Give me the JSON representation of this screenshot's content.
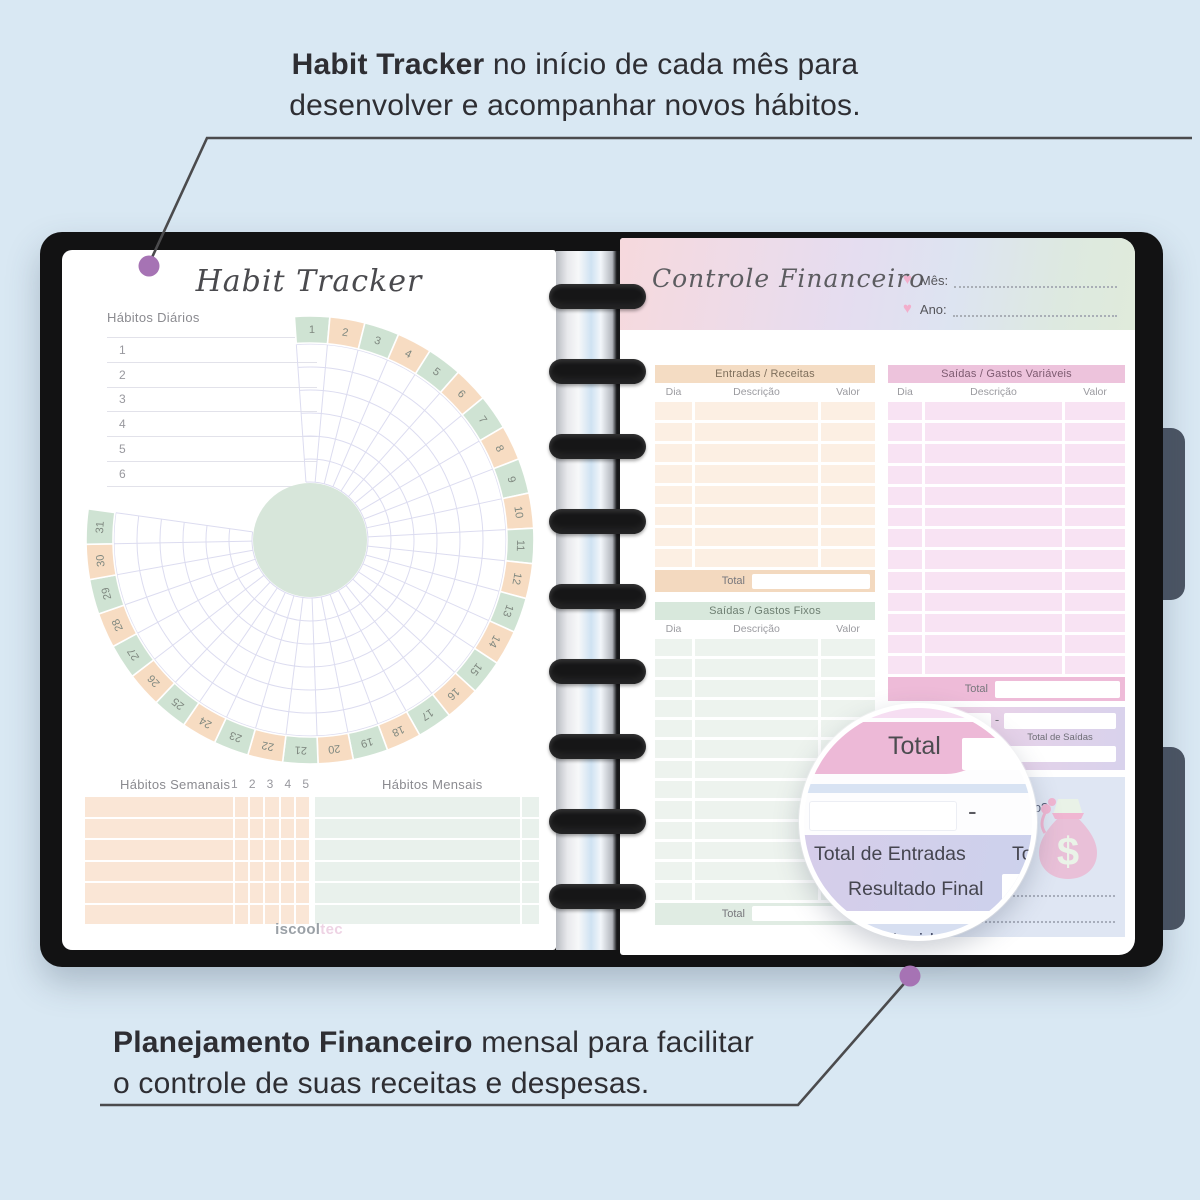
{
  "annotations": {
    "top": {
      "highlight": "Habit Tracker",
      "line1_rest": " no início de cada mês para",
      "line2": "desenvolver e acompanhar novos hábitos."
    },
    "bottom": {
      "highlight": "Planejamento Financeiro",
      "line1_rest": " mensal para facilitar",
      "line2": "o controle de suas receitas e despesas."
    }
  },
  "left_page": {
    "title": "Habit Tracker",
    "daily_habits": {
      "label": "Hábitos Diários",
      "rows": [
        "1",
        "2",
        "3",
        "4",
        "5",
        "6"
      ]
    },
    "tracker": {
      "days": 31,
      "day_labels": [
        "1",
        "2",
        "3",
        "4",
        "5",
        "6",
        "7",
        "8",
        "9",
        "10",
        "11",
        "12",
        "13",
        "14",
        "15",
        "16",
        "17",
        "18",
        "19",
        "20",
        "21",
        "22",
        "23",
        "24",
        "25",
        "26",
        "27",
        "28",
        "29",
        "30",
        "31"
      ],
      "rings": 6,
      "color_odd": "#cfe3d3",
      "color_even": "#f7dcc2",
      "center_color": "#d7e6da",
      "grid_color": "#dcdcf0"
    },
    "weekly_habits": {
      "label": "Hábitos Semanais",
      "columns": [
        "1",
        "2",
        "3",
        "4",
        "5"
      ],
      "rows": 6,
      "cell_color": "#fae6d6"
    },
    "monthly_habits": {
      "label": "Hábitos Mensais",
      "rows": 6,
      "cell_color": "#e9f1ec"
    },
    "brand": {
      "part1": "iscool",
      "part2": "tec"
    }
  },
  "right_page": {
    "title": "Controle Financeiro",
    "heart_icon": "♥",
    "month_label": "Mês:",
    "year_label": "Ano:",
    "entradas": {
      "title": "Entradas / Receitas",
      "col_dia": "Dia",
      "col_desc": "Descrição",
      "col_valor": "Valor",
      "rows": 8,
      "row_height": 18,
      "total_label": "Total",
      "header_color": "#f4dcc3",
      "row_color": "#fcefe3",
      "total_color": "#f3d9bf"
    },
    "fixos": {
      "title": "Saídas / Gastos Fixos",
      "col_dia": "Dia",
      "col_desc": "Descrição",
      "col_valor": "Valor",
      "rows": 13,
      "row_height": 17.3,
      "total_label": "Total",
      "header_color": "#d8e8dc",
      "row_color": "#edf3ee",
      "total_color": "#e0ece3"
    },
    "variaveis": {
      "title": "Saídas / Gastos Variáveis",
      "col_dia": "Dia",
      "col_desc": "Descrição",
      "col_valor": "Valor",
      "rows": 13,
      "row_height": 18.2,
      "total_label": "Total",
      "header_color": "#edc3dc",
      "row_color": "#f8e3f3",
      "total_color": "#eebbd8"
    },
    "summary": {
      "minus": "-",
      "entradas_label": "Total de Entradas",
      "saidas_label": "Total de Saídas",
      "resultado_label": "Resultado Final"
    },
    "goals": {
      "q1": "Metas atingidas?",
      "q2": "Foi conforme o planejado?",
      "money_icon": "$"
    }
  },
  "magnifier": {
    "total": "Total",
    "minus": "-",
    "entradas": "Total de Entradas",
    "saidas_clip": "Total de Saídas",
    "resultado": "Resultado Final",
    "q1": "Metas atingidas?",
    "q2": "Foi conforme o planejado?"
  },
  "colors": {
    "background": "#d9e8f3",
    "cover": "#121213",
    "side_tab": "#4c5564",
    "callout_dot": "#a673b4",
    "leader_line": "#4b4b4d",
    "heart": "#f2aecb",
    "money_bag": "#e9c0d8"
  }
}
